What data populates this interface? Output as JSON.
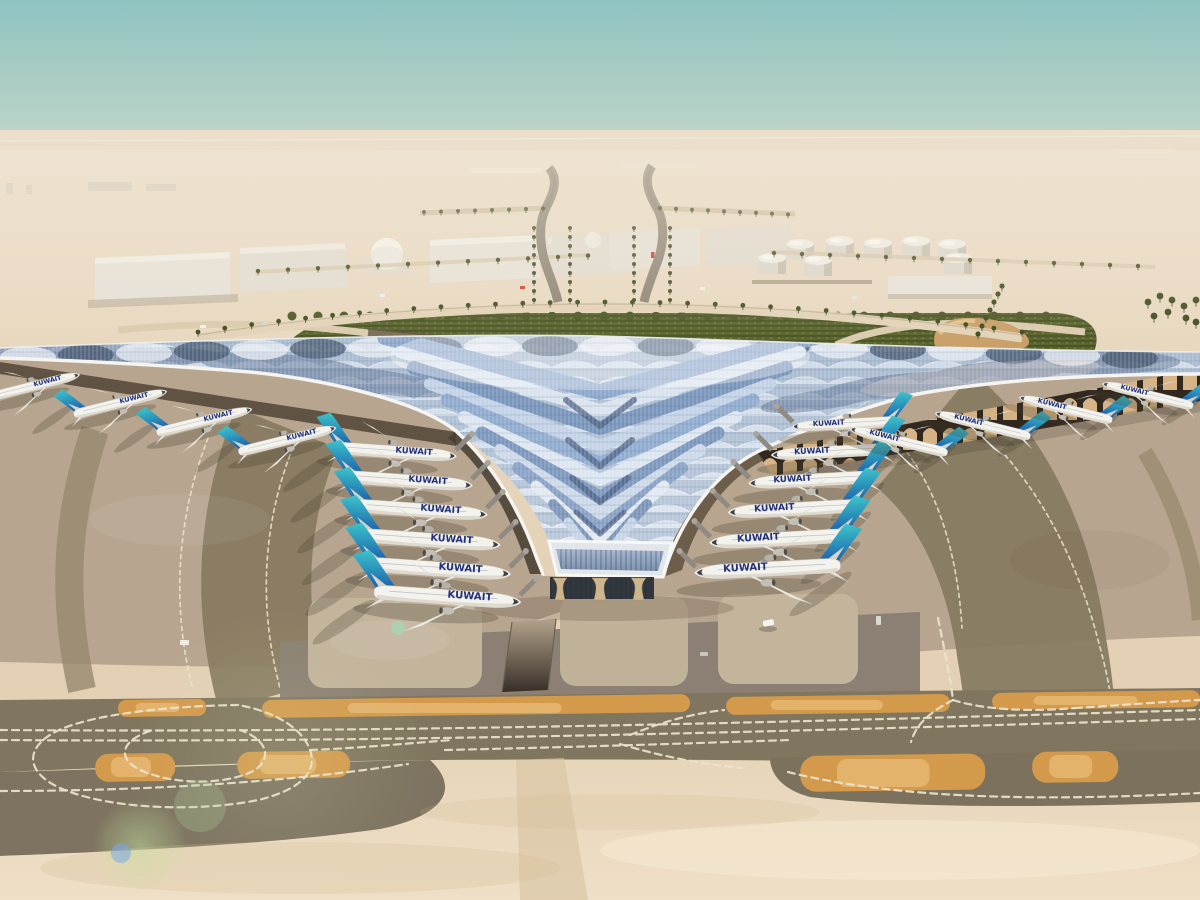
{
  "scene": {
    "title": "Aerial rendering of Kuwait International Airport new terminal in desert",
    "setting": "desert airport, hazy day, aerial oblique view",
    "airline_title": "KUWAIT",
    "colors": {
      "sky_top": "#8fc3c1",
      "sky_mid": "#b8d2c6",
      "sky_haze": "#e9dbc6",
      "desert_far": "#ecdfcb",
      "desert_mid": "#e3d0b4",
      "sand_bottom": "#efdfc6",
      "apron": "#b7a58f",
      "apron_band": "#87795f",
      "asphalt": "#80765f",
      "asphalt_low": "#7b715c",
      "island_orange": "#d49a4c",
      "marking": "#ece3cd",
      "roof_white": "#f5f4f1",
      "roof_blue": "#9db5d6",
      "roof_slate": "#5a7093",
      "green": "#57622c",
      "palm": "#3f4a1e",
      "tail_teal": "#3fc4c9",
      "tail_blue": "#1c55a9",
      "fuselage": "#f3f2ec",
      "title_navy": "#23327a",
      "underside_dark": "#4b4237",
      "arch_gold": "#d9b587",
      "column_tan": "#cdb58d",
      "building_white": "#e9e4da",
      "trench": "#7b6c54"
    },
    "terminal": {
      "roof_style": "swept trident canopy with scalloped blue solar glazing",
      "chevron_rows": 12,
      "entrance_columns": 3
    },
    "aircraft": {
      "airline_title": "KUWAIT",
      "livery": "white fuselage, teal-to-blue swept tail",
      "groups": [
        {
          "name": "left-gates",
          "mirror": false,
          "rotate": 4,
          "label": true,
          "bridge": true,
          "planes": [
            [
              395,
              452,
              1.05
            ],
            [
              408,
              481,
              1.1
            ],
            [
              420,
              510,
              1.15
            ],
            [
              430,
              540,
              1.2
            ],
            [
              438,
              569,
              1.24
            ],
            [
              447,
              597,
              1.26
            ]
          ]
        },
        {
          "name": "right-gates",
          "mirror": true,
          "rotate": -3,
          "label": true,
          "bridge": true,
          "planes": [
            [
              845,
              424,
              0.9
            ],
            [
              830,
              452,
              1.0
            ],
            [
              812,
              480,
              1.08
            ],
            [
              795,
              509,
              1.14
            ],
            [
              780,
              539,
              1.2
            ],
            [
              768,
              569,
              1.25
            ]
          ]
        },
        {
          "name": "left-pier",
          "mirror": false,
          "rotate": -14,
          "label": true,
          "bridge": false,
          "planes": [
            [
              34,
              386,
              0.8
            ],
            [
              120,
              403,
              0.82
            ],
            [
              204,
              421,
              0.84
            ],
            [
              287,
              440,
              0.86
            ]
          ]
        },
        {
          "name": "right-pier",
          "mirror": true,
          "rotate": 14,
          "label": true,
          "bridge": false,
          "planes": [
            [
              899,
              441,
              0.86
            ],
            [
              983,
              425,
              0.84
            ],
            [
              1066,
              409,
              0.82
            ],
            [
              1148,
              395,
              0.8
            ]
          ]
        }
      ]
    },
    "landside": {
      "fuel_tank_positions": [
        [
          800,
          244
        ],
        [
          840,
          241
        ],
        [
          878,
          243
        ],
        [
          916,
          241
        ],
        [
          952,
          244
        ],
        [
          772,
          258
        ],
        [
          818,
          260
        ],
        [
          958,
          258
        ]
      ],
      "warehouse_count": 7,
      "dome_count": 2,
      "palm_lined_roads": true,
      "green_band": true
    },
    "airside": {
      "orange_islands": 8,
      "dashed_taxi_lines": true,
      "tunnel_ramp": true
    }
  }
}
